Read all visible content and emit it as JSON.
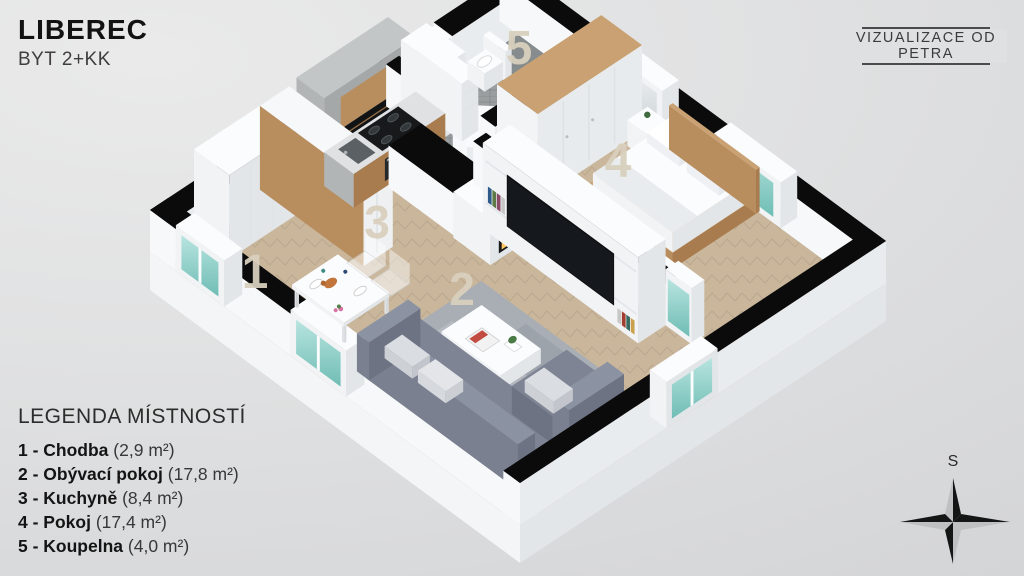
{
  "header": {
    "title": "LIBEREC",
    "subtitle": "BYT 2+KK"
  },
  "badge": {
    "text": "VIZUALIZACE OD PETRA"
  },
  "legend": {
    "title": "LEGENDA MÍSTNOSTÍ",
    "items": [
      {
        "bold": "1 - Chodba",
        "area": "(2,9 m²)"
      },
      {
        "bold": "2 - Obývací pokoj",
        "area": "(17,8 m²)"
      },
      {
        "bold": "3 - Kuchyně",
        "area": "(8,4 m²)"
      },
      {
        "bold": "4 - Pokoj",
        "area": "(17,4 m²)"
      },
      {
        "bold": "5 - Koupelna",
        "area": "(4,0 m²)"
      }
    ]
  },
  "rooms": [
    {
      "plan_label": "1"
    },
    {
      "plan_label": "2"
    },
    {
      "plan_label": "3"
    },
    {
      "plan_label": "4"
    },
    {
      "plan_label": "5"
    }
  ],
  "compass": {
    "label": "S"
  },
  "colors": {
    "wall_black": "#0b0b0c",
    "wall_white": "#f6f8f9",
    "floor_wood": "#c9b69b",
    "wood_accent": "#c9a172",
    "glass_teal": "#6fbdb5",
    "glass_teal_light": "#b8e4df",
    "fire_orange": "#ff9a2e",
    "sofa_gray": "#7e8494",
    "bath_tile_gray": "#9a9e9f",
    "label_beige": "#d9d0bd"
  }
}
